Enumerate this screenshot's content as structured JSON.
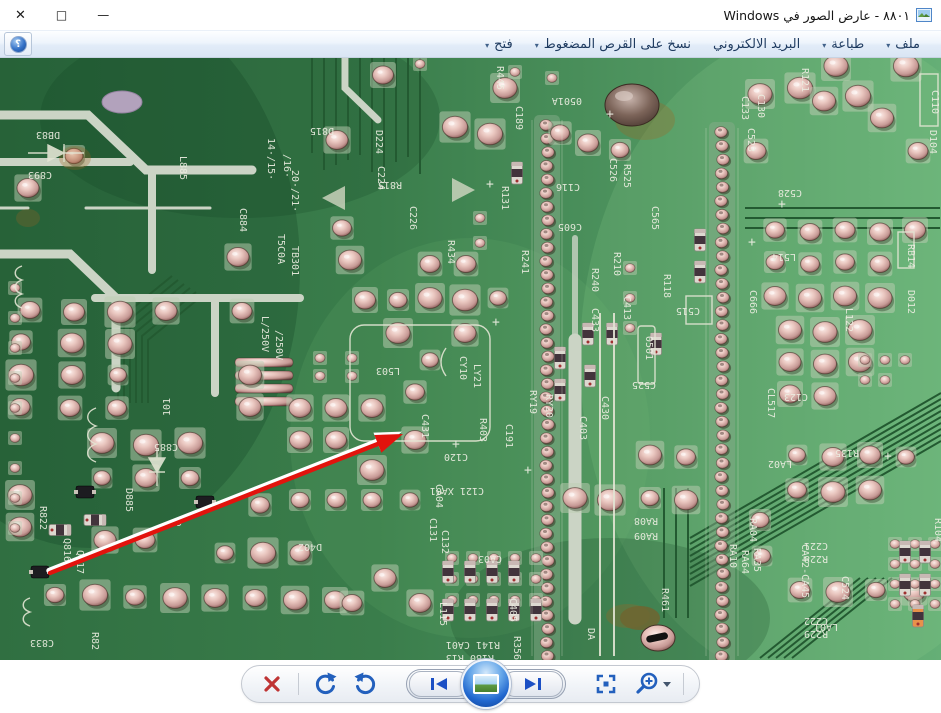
{
  "window": {
    "title": "٨٨٠١ - عارض الصور في Windows"
  },
  "icons": {
    "close": "✕",
    "maximize": "□",
    "minimize": "—",
    "dropdown": "▾",
    "help": "؟"
  },
  "toolbar": {
    "items": [
      {
        "id": "file",
        "label": "ملف",
        "dropdown": true
      },
      {
        "id": "print",
        "label": "طباعة",
        "dropdown": true
      },
      {
        "id": "email",
        "label": "البريد الالكتروني",
        "dropdown": false
      },
      {
        "id": "burn",
        "label": "نسخ على القرص المضغوط",
        "dropdown": true
      },
      {
        "id": "open",
        "label": "فتح",
        "dropdown": true
      }
    ]
  },
  "bottom_toolbar": {
    "buttons": [
      "delete",
      "rotate-clockwise",
      "rotate-counterclockwise",
      "previous",
      "slideshow",
      "next",
      "actual-size",
      "zoom"
    ]
  },
  "photo": {
    "description": "macro photo of a green printed circuit board, solder side, with a red annotation arrow",
    "arrow_target": "C431",
    "arrow": {
      "tail": [
        50,
        515
      ],
      "tip": [
        403,
        376
      ]
    },
    "colors": {
      "board_dark": "#306f41",
      "board_light": "#65af76",
      "trace": "#235a31",
      "pale_trace": "#cbd4c5",
      "silkscreen": "#edeee2",
      "pad": "#e9c9c2",
      "arrow_red": "#e2130d"
    },
    "strips": [
      {
        "x": 547,
        "y0": 67,
        "y1": 598,
        "n": 40
      },
      {
        "x": 722,
        "y0": 74,
        "y1": 598,
        "n": 39
      }
    ],
    "labels": [
      [
        "R445",
        497,
        8,
        90
      ],
      [
        "D815",
        334,
        70,
        180
      ],
      [
        "R815",
        402,
        124,
        180
      ],
      [
        "D224",
        376,
        72,
        90
      ],
      [
        "C224",
        378,
        108,
        90
      ],
      [
        "C226",
        410,
        148,
        90
      ],
      [
        "R131",
        502,
        128,
        90
      ],
      [
        "R434",
        448,
        182,
        90
      ],
      [
        "R241",
        522,
        192,
        90
      ],
      [
        "C189",
        516,
        48,
        90
      ],
      [
        "C893",
        52,
        114,
        180
      ],
      [
        "DB83",
        60,
        74,
        180
      ],
      [
        "L885",
        180,
        98,
        90
      ],
      [
        "C884",
        240,
        150,
        90
      ],
      [
        "14·/15·",
        268,
        80,
        90
      ],
      [
        "/16·",
        284,
        96,
        90
      ],
      [
        "20·/21·",
        292,
        112,
        90
      ],
      [
        "T5C0A",
        278,
        176,
        90
      ],
      [
        "TB301",
        292,
        188,
        90
      ],
      [
        "L/250V",
        262,
        258,
        90
      ],
      [
        "/250V",
        276,
        272,
        90
      ],
      [
        "0501A",
        582,
        40,
        180
      ],
      [
        "C133",
        742,
        38,
        90
      ],
      [
        "C526",
        610,
        100,
        90
      ],
      [
        "R525",
        624,
        106,
        90
      ],
      [
        "C116",
        580,
        126,
        180
      ],
      [
        "C605",
        582,
        166,
        180
      ],
      [
        "C565",
        652,
        148,
        90
      ],
      [
        "R210",
        614,
        194,
        90
      ],
      [
        "R118",
        664,
        216,
        90
      ],
      [
        "R240",
        592,
        210,
        90
      ],
      [
        "C433",
        592,
        250,
        90
      ],
      [
        "C413",
        624,
        238,
        90
      ],
      [
        "C430",
        602,
        338,
        90
      ],
      [
        "C515",
        700,
        250,
        180
      ],
      [
        "0501",
        646,
        278,
        90
      ],
      [
        "C525",
        656,
        324,
        180
      ],
      [
        "C403",
        580,
        358,
        90
      ],
      [
        "C523",
        748,
        70,
        90
      ],
      [
        "C130",
        758,
        36,
        90
      ],
      [
        "R121",
        802,
        10,
        90
      ],
      [
        "C528",
        802,
        132,
        180
      ],
      [
        "L514",
        796,
        196,
        180
      ],
      [
        "C666",
        750,
        232,
        90
      ],
      [
        "C123",
        808,
        336,
        180
      ],
      [
        "L122",
        846,
        250,
        90
      ],
      [
        "D104",
        930,
        72,
        90
      ],
      [
        "D012",
        908,
        232,
        90
      ],
      [
        "C110",
        932,
        32,
        90
      ],
      [
        "CL517",
        768,
        330,
        90
      ],
      [
        "RB14",
        908,
        186,
        90
      ],
      [
        "C885",
        178,
        386,
        180
      ],
      [
        "D885",
        126,
        430,
        90
      ],
      [
        "R822",
        40,
        448,
        90
      ],
      [
        "Q816",
        64,
        480,
        90
      ],
      [
        "Q817",
        77,
        492,
        90
      ],
      [
        "C833",
        54,
        582,
        180
      ],
      [
        "R82",
        92,
        574,
        90
      ],
      [
        "9",
        176,
        468,
        0
      ],
      [
        "101",
        170,
        358,
        -90
      ],
      [
        "C120",
        468,
        396,
        180
      ],
      [
        "CA04",
        436,
        426,
        90
      ],
      [
        "C121 XA01",
        484,
        430,
        180
      ],
      [
        "C131",
        430,
        460,
        90
      ],
      [
        "C132",
        442,
        472,
        90
      ],
      [
        "CA03",
        502,
        498,
        180
      ],
      [
        "L115",
        440,
        544,
        90
      ],
      [
        "R141 CA01",
        500,
        584,
        180
      ],
      [
        "R180 R13",
        494,
        597,
        180
      ],
      [
        "RA08",
        658,
        460,
        180
      ],
      [
        "RA09",
        658,
        475,
        180
      ],
      [
        "RA10",
        730,
        486,
        90
      ],
      [
        "RA64",
        742,
        492,
        90
      ],
      [
        "RA35",
        754,
        490,
        90
      ],
      [
        "R461",
        662,
        530,
        90
      ],
      [
        "DA",
        588,
        570,
        90
      ],
      [
        "LA02",
        792,
        403,
        180
      ],
      [
        "RA04",
        750,
        460,
        90
      ],
      [
        "CA42-CA45",
        802,
        486,
        90
      ],
      [
        "LA01",
        838,
        566,
        180
      ],
      [
        "R135",
        859,
        392,
        180
      ],
      [
        "C221",
        828,
        485,
        180
      ],
      [
        "R228",
        828,
        498,
        180
      ],
      [
        "C524",
        842,
        518,
        90
      ],
      [
        "C222",
        828,
        560,
        180
      ],
      [
        "R229",
        828,
        573,
        180
      ],
      [
        "RY19",
        530,
        332,
        90
      ],
      [
        "RY20",
        546,
        336,
        90
      ],
      [
        "CY10",
        460,
        298,
        90
      ],
      [
        "LY21",
        474,
        306,
        90
      ],
      [
        "R403",
        480,
        360,
        90
      ],
      [
        "C191",
        506,
        366,
        90
      ],
      [
        "C431",
        422,
        356,
        90
      ],
      [
        "L503",
        400,
        310,
        180
      ],
      [
        "D402",
        322,
        486,
        180
      ],
      [
        "C405",
        510,
        540,
        90
      ],
      [
        "R356",
        514,
        578,
        90
      ],
      [
        "R104",
        935,
        460,
        90
      ],
      [
        "+",
        452,
        390,
        0
      ],
      [
        "+",
        492,
        268,
        0
      ],
      [
        "+",
        524,
        416,
        0
      ],
      [
        "+",
        778,
        150,
        0
      ],
      [
        "+",
        748,
        188,
        0
      ],
      [
        "+",
        884,
        402,
        0
      ],
      [
        "+",
        606,
        60,
        0
      ],
      [
        "+",
        486,
        130,
        0
      ]
    ],
    "pads_large": [
      [
        383,
        17
      ],
      [
        455,
        69
      ],
      [
        490,
        76
      ],
      [
        588,
        85
      ],
      [
        620,
        92
      ],
      [
        760,
        36
      ],
      [
        800,
        30
      ],
      [
        824,
        43
      ],
      [
        858,
        38
      ],
      [
        882,
        60
      ],
      [
        836,
        8
      ],
      [
        906,
        8
      ],
      [
        918,
        93
      ],
      [
        756,
        93
      ],
      [
        74,
        98
      ],
      [
        28,
        130
      ],
      [
        238,
        199
      ],
      [
        242,
        253
      ],
      [
        166,
        253
      ],
      [
        120,
        254
      ],
      [
        74,
        254
      ],
      [
        30,
        252
      ],
      [
        21,
        284
      ],
      [
        72,
        285
      ],
      [
        120,
        286
      ],
      [
        21,
        317
      ],
      [
        72,
        317
      ],
      [
        118,
        317
      ],
      [
        20,
        349
      ],
      [
        70,
        350
      ],
      [
        117,
        350
      ],
      [
        250,
        317
      ],
      [
        250,
        349
      ],
      [
        337,
        82
      ],
      [
        342,
        170
      ],
      [
        350,
        202
      ],
      [
        365,
        242
      ],
      [
        398,
        242
      ],
      [
        430,
        240
      ],
      [
        465,
        242
      ],
      [
        498,
        240
      ],
      [
        430,
        206
      ],
      [
        466,
        206
      ],
      [
        398,
        275
      ],
      [
        430,
        302
      ],
      [
        465,
        275
      ],
      [
        300,
        350
      ],
      [
        336,
        350
      ],
      [
        372,
        350
      ],
      [
        300,
        382
      ],
      [
        336,
        382
      ],
      [
        415,
        334
      ],
      [
        415,
        382
      ],
      [
        372,
        412
      ],
      [
        410,
        442
      ],
      [
        372,
        442
      ],
      [
        336,
        442
      ],
      [
        300,
        442
      ],
      [
        260,
        447
      ],
      [
        225,
        495
      ],
      [
        263,
        495
      ],
      [
        300,
        495
      ],
      [
        102,
        385
      ],
      [
        102,
        420
      ],
      [
        146,
        387
      ],
      [
        190,
        385
      ],
      [
        146,
        420
      ],
      [
        190,
        420
      ],
      [
        55,
        537
      ],
      [
        95,
        537
      ],
      [
        135,
        539
      ],
      [
        175,
        540
      ],
      [
        215,
        540
      ],
      [
        255,
        540
      ],
      [
        295,
        542
      ],
      [
        335,
        542
      ],
      [
        105,
        482
      ],
      [
        145,
        482
      ],
      [
        20,
        437
      ],
      [
        20,
        469
      ],
      [
        775,
        172
      ],
      [
        810,
        174
      ],
      [
        845,
        172
      ],
      [
        880,
        174
      ],
      [
        915,
        172
      ],
      [
        775,
        204
      ],
      [
        810,
        206
      ],
      [
        845,
        204
      ],
      [
        880,
        206
      ],
      [
        775,
        238
      ],
      [
        810,
        240
      ],
      [
        845,
        238
      ],
      [
        880,
        240
      ],
      [
        790,
        272
      ],
      [
        825,
        274
      ],
      [
        860,
        272
      ],
      [
        790,
        304
      ],
      [
        825,
        306
      ],
      [
        860,
        304
      ],
      [
        790,
        336
      ],
      [
        825,
        338
      ],
      [
        797,
        397
      ],
      [
        833,
        399
      ],
      [
        870,
        397
      ],
      [
        906,
        399
      ],
      [
        797,
        432
      ],
      [
        833,
        434
      ],
      [
        870,
        432
      ],
      [
        760,
        462
      ],
      [
        762,
        498
      ],
      [
        800,
        532
      ],
      [
        838,
        534
      ],
      [
        876,
        532
      ],
      [
        914,
        534
      ],
      [
        650,
        397
      ],
      [
        686,
        399
      ],
      [
        575,
        440
      ],
      [
        610,
        442
      ],
      [
        650,
        440
      ],
      [
        686,
        442
      ],
      [
        385,
        520
      ],
      [
        420,
        545
      ],
      [
        352,
        545
      ],
      [
        560,
        75
      ],
      [
        505,
        30
      ]
    ],
    "pads_small": [
      [
        15,
        230
      ],
      [
        15,
        260
      ],
      [
        15,
        290
      ],
      [
        15,
        320
      ],
      [
        15,
        350
      ],
      [
        15,
        380
      ],
      [
        15,
        410
      ],
      [
        15,
        440
      ],
      [
        15,
        470
      ],
      [
        452,
        500
      ],
      [
        473,
        500
      ],
      [
        494,
        500
      ],
      [
        515,
        500
      ],
      [
        536,
        500
      ],
      [
        452,
        521
      ],
      [
        473,
        521
      ],
      [
        494,
        521
      ],
      [
        515,
        521
      ],
      [
        536,
        521
      ],
      [
        452,
        542
      ],
      [
        473,
        542
      ],
      [
        494,
        542
      ],
      [
        515,
        542
      ],
      [
        536,
        542
      ],
      [
        895,
        486
      ],
      [
        915,
        486
      ],
      [
        935,
        486
      ],
      [
        895,
        506
      ],
      [
        915,
        506
      ],
      [
        935,
        506
      ],
      [
        895,
        526
      ],
      [
        915,
        526
      ],
      [
        935,
        526
      ],
      [
        895,
        546
      ],
      [
        915,
        546
      ],
      [
        935,
        546
      ],
      [
        865,
        302
      ],
      [
        885,
        302
      ],
      [
        905,
        302
      ],
      [
        865,
        322
      ],
      [
        885,
        322
      ],
      [
        352,
        300
      ],
      [
        352,
        318
      ],
      [
        320,
        300
      ],
      [
        320,
        318
      ],
      [
        420,
        6
      ],
      [
        515,
        14
      ],
      [
        552,
        20
      ],
      [
        630,
        210
      ],
      [
        630,
        240
      ],
      [
        630,
        270
      ],
      [
        480,
        160
      ],
      [
        480,
        185
      ]
    ],
    "smd": [
      [
        588,
        276,
        0,
        0
      ],
      [
        612,
        276,
        0,
        0
      ],
      [
        656,
        286,
        0,
        0
      ],
      [
        700,
        182,
        0,
        0
      ],
      [
        700,
        214,
        0,
        0
      ],
      [
        590,
        318,
        0,
        0
      ],
      [
        517,
        115,
        0,
        0
      ],
      [
        448,
        514,
        0,
        0
      ],
      [
        470,
        514,
        0,
        0
      ],
      [
        492,
        514,
        0,
        0
      ],
      [
        514,
        514,
        0,
        0
      ],
      [
        448,
        552,
        0,
        0
      ],
      [
        470,
        552,
        0,
        0
      ],
      [
        492,
        552,
        0,
        0
      ],
      [
        514,
        552,
        0,
        0
      ],
      [
        536,
        552,
        0,
        0
      ],
      [
        905,
        494,
        0,
        0
      ],
      [
        925,
        494,
        0,
        0
      ],
      [
        905,
        527,
        0,
        0
      ],
      [
        925,
        527,
        0,
        0
      ],
      [
        918,
        558,
        0,
        1
      ],
      [
        60,
        472,
        90,
        0
      ],
      [
        95,
        462,
        90,
        0
      ],
      [
        560,
        300,
        0,
        0
      ],
      [
        560,
        332,
        0,
        0
      ]
    ],
    "transistors": [
      [
        85,
        434
      ],
      [
        205,
        444
      ],
      [
        40,
        514
      ]
    ],
    "bars": [
      [
        235,
        300
      ],
      [
        235,
        313
      ],
      [
        235,
        326
      ],
      [
        235,
        339
      ]
    ]
  }
}
